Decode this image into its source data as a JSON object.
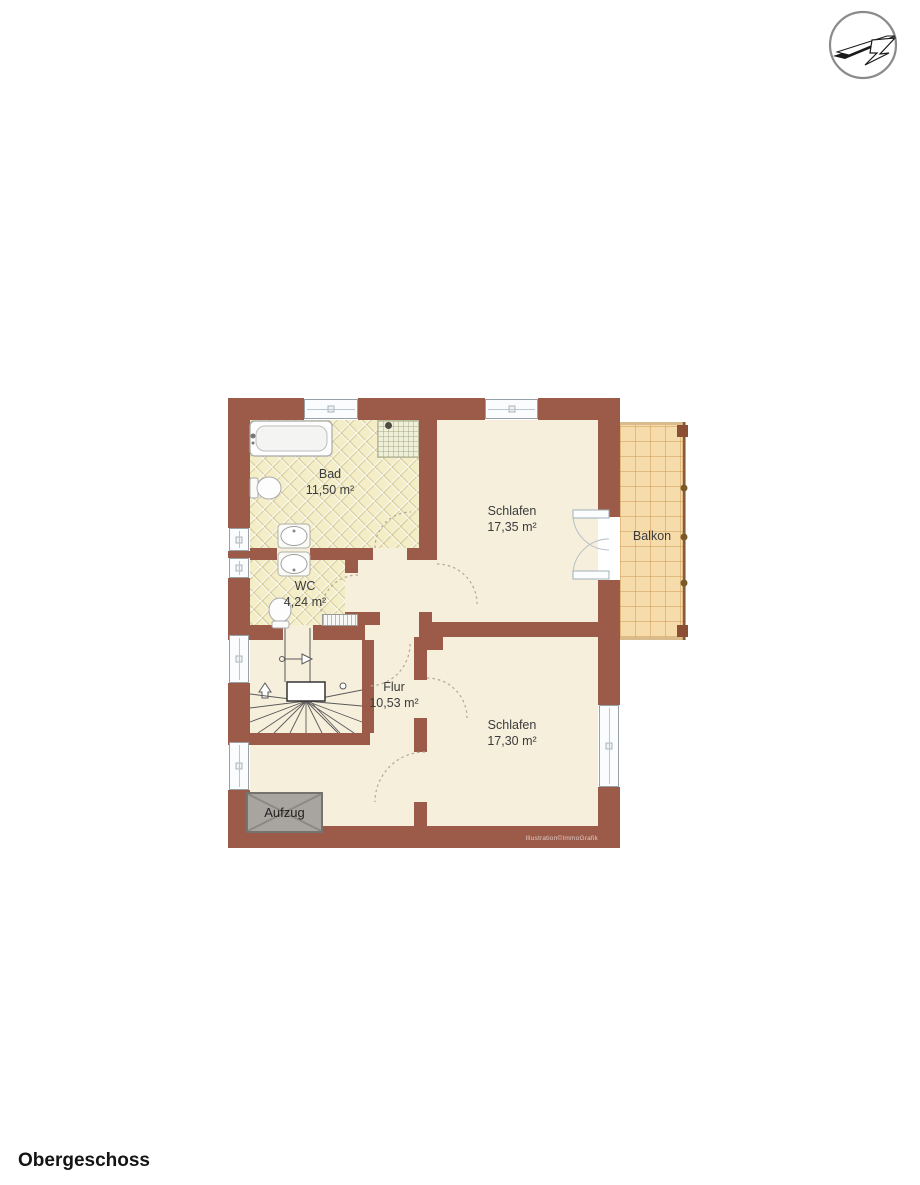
{
  "title": {
    "floor_label": "Obergeschoss"
  },
  "floor_plan": {
    "watermark": "Illustration©ImmoGrafik",
    "rooms": {
      "bad": {
        "name": "Bad",
        "area": "11,50 m²"
      },
      "wc": {
        "name": "WC",
        "area": "4,24 m²"
      },
      "schlafen_top": {
        "name": "Schlafen",
        "area": "17,35 m²"
      },
      "schlafen_bottom": {
        "name": "Schlafen",
        "area": "17,30 m²"
      },
      "flur": {
        "name": "Flur",
        "area": "10,53 m²"
      },
      "balkon": {
        "name": "Balkon"
      },
      "aufzug": {
        "name": "Aufzug"
      }
    },
    "colors": {
      "wall": "#9c5a49",
      "room_floor": "#f6efdc",
      "bath_tile": "#f3edc8",
      "balcony_tile": "#f7dcab",
      "elevator_fill": "#a8a4a0"
    }
  }
}
